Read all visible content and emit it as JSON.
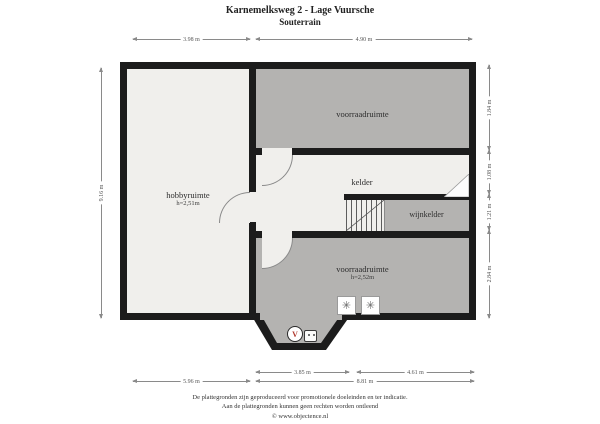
{
  "title": {
    "line1": "Karnemelksweg 2 - Lage Vuursche",
    "line2": "Souterrain"
  },
  "rooms": {
    "hobby": {
      "label": "hobbyruimte",
      "height": "h=2,51m"
    },
    "storage_top": {
      "label": "voorraadruimte"
    },
    "cellar": {
      "label": "kelder"
    },
    "wine_cellar": {
      "label": "wijnkelder"
    },
    "storage_bottom": {
      "label": "voorraadruimte",
      "height": "h=2,52m"
    }
  },
  "dimensions": {
    "top_left": "3.98 m",
    "top_right": "4.90 m",
    "left_side": "9.16 m",
    "right_1": "1.84 m",
    "right_2": "1.08 m",
    "right_3": "1.21 m",
    "right_4": "2.84 m",
    "bottom_inner_left": "3.85 m",
    "bottom_inner_right": "4.61 m",
    "bottom_outer_left": "5.96 m",
    "bottom_outer_right": "8.81 m"
  },
  "symbols": {
    "appliance_mark": "✳",
    "heater_mark": "V"
  },
  "footer": {
    "line1": "De plattegronden zijn geproduceerd voor promotionele doeleinden en ter indicatie.",
    "line2": "Aan de plattegronden kunnen geen rechten worden ontleend",
    "line3": "© www.objectence.nl"
  },
  "colors": {
    "wall": "#1c1c1c",
    "room_light": "#f0efec",
    "room_gray": "#b4b3b1",
    "accent_red": "#b03a30",
    "dim_line": "#8a8a8a"
  }
}
